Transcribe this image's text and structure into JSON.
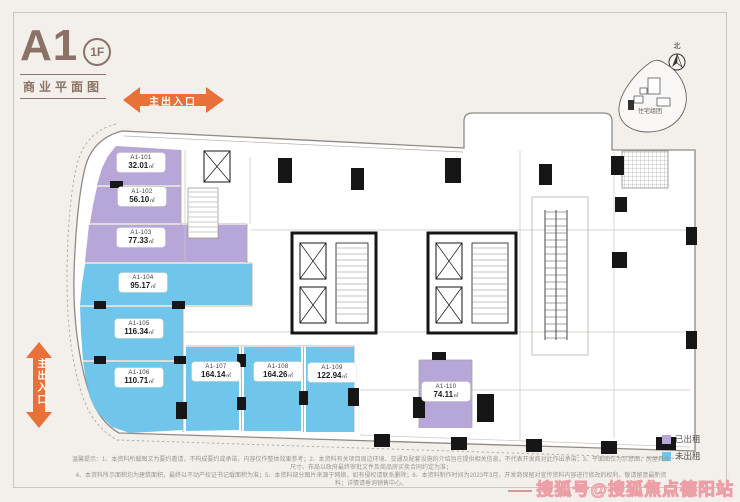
{
  "header": {
    "block": "A1",
    "floor": "1F",
    "subtitle": "商业平面图"
  },
  "entrances": {
    "top": "主出入口",
    "left": "主出入口"
  },
  "compass": {
    "north_label": "北"
  },
  "sitemap_label": "住宅组团",
  "area_unit": "㎡",
  "colors": {
    "rented": "#b7a7d8",
    "vacant": "#70c6ea",
    "arrow": "#e8713a",
    "title_brown": "#8b7266",
    "wall_black": "#161616"
  },
  "units": [
    {
      "id": "A1-101",
      "area": "32.01",
      "status": "rented"
    },
    {
      "id": "A1-102",
      "area": "56.10",
      "status": "rented"
    },
    {
      "id": "A1-103",
      "area": "77.33",
      "status": "rented"
    },
    {
      "id": "A1-104",
      "area": "95.17",
      "status": "vacant"
    },
    {
      "id": "A1-105",
      "area": "116.34",
      "status": "vacant"
    },
    {
      "id": "A1-106",
      "area": "110.71",
      "status": "vacant"
    },
    {
      "id": "A1-107",
      "area": "164.14",
      "status": "vacant"
    },
    {
      "id": "A1-108",
      "area": "164.26",
      "status": "vacant"
    },
    {
      "id": "A1-109",
      "area": "122.94",
      "status": "vacant"
    },
    {
      "id": "A1-110",
      "area": "74.11",
      "status": "rented"
    }
  ],
  "legend": {
    "rented": "已出租",
    "vacant": "未出租"
  },
  "footer": {
    "line1": "温馨提示：1、本资料所载图文为要约邀请，不构成要约或承诺，内容仅作整体效果参考；2、本资料有关项目周边环境、交通及配套设施的介绍旨在提供相关信息，不代表开发商对此作出承诺；3、平面图仅为示意图，房屋具体尺寸、布局以政府最终审批文件及商品房买卖合同约定为准；",
    "line2": "4、本资料所示面积均为建筑面积，最终以不动产权证书记载面积为准；5、本资料部分图片来源于网络，如有侵权请联系删除；6、本资料制作时间为2023年3月，开发商保留对宣传资料内容进行修改的权利，敬请留意最新资料；详情请垂询销售中心。"
  },
  "watermark": "搜狐号@搜狐焦点德阳站"
}
